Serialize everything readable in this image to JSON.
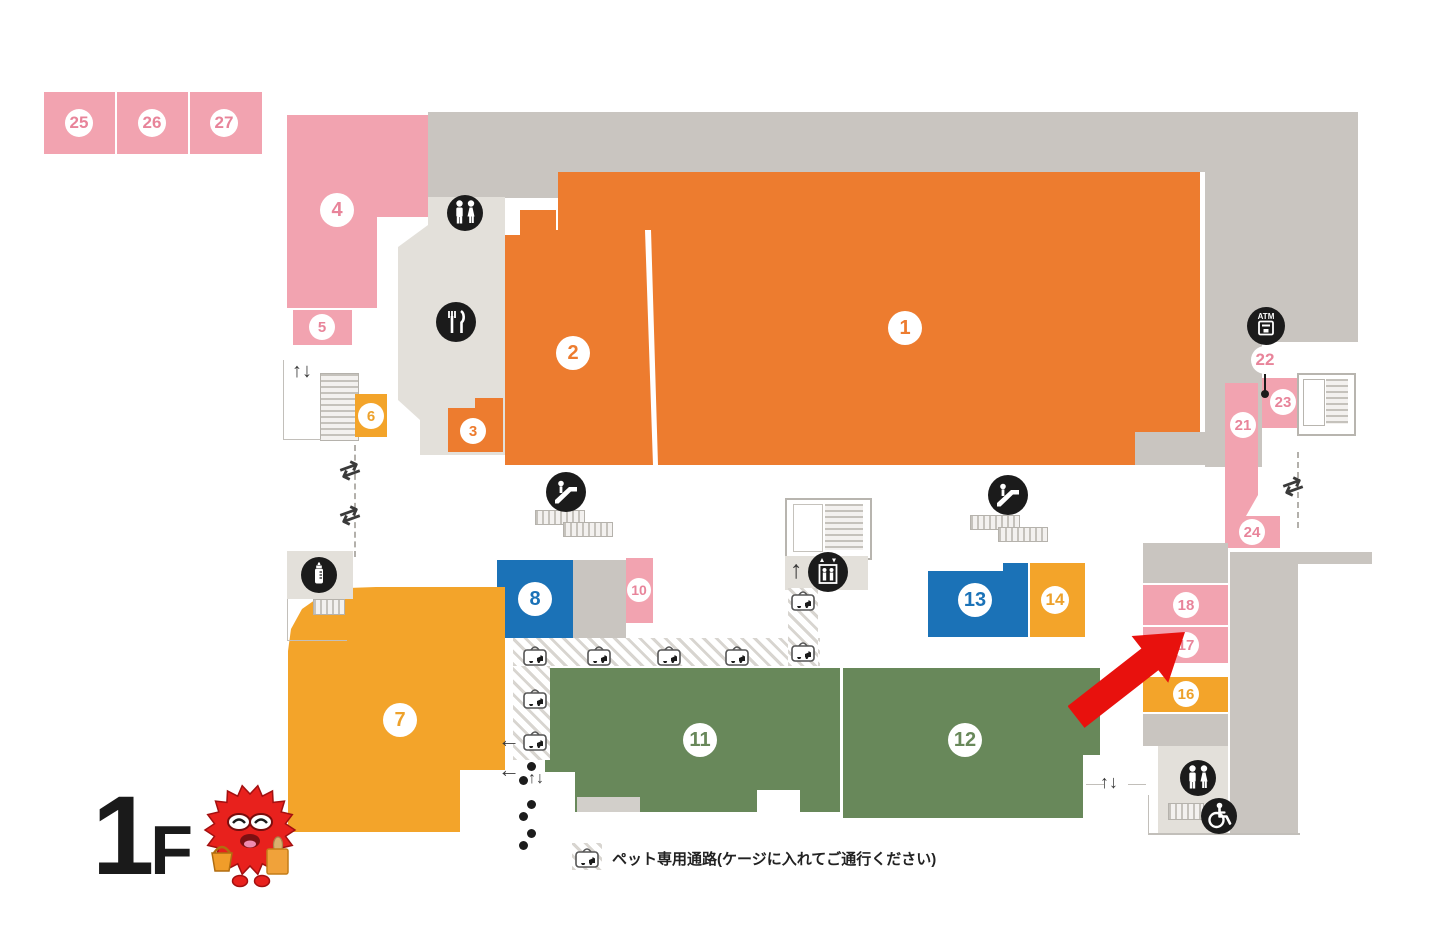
{
  "floor": {
    "label_number": "1",
    "label_letter": "F"
  },
  "legend": {
    "pet_path_text": "ペット専用通路(ケージに入れてご通行ください)"
  },
  "icons": {
    "atm_label": "ATM"
  },
  "arrows": {
    "up_down": "↑↓",
    "two_way": "⇄",
    "left": "←",
    "up": "↑"
  },
  "palette": {
    "pink": "#f2a3b0",
    "orange": "#ed7c2f",
    "amber": "#f3a42a",
    "blue": "#1b72b7",
    "green": "#68885a",
    "gray": "#c9c5c0",
    "light_gray": "#e3e0da",
    "red_arrow": "#e8110d",
    "icon_black": "#1b1b1b"
  },
  "areas": {
    "a1": {
      "label": "1",
      "color": "#ed7c2f"
    },
    "a2": {
      "label": "2",
      "color": "#ed7c2f"
    },
    "a3": {
      "label": "3",
      "color": "#ed7c2f"
    },
    "a4": {
      "label": "4",
      "color": "#f2a3b0"
    },
    "a5": {
      "label": "5",
      "color": "#f2a3b0"
    },
    "a6": {
      "label": "6",
      "color": "#f3a42a"
    },
    "a7": {
      "label": "7",
      "color": "#f3a42a"
    },
    "a8": {
      "label": "8",
      "color": "#1b72b7"
    },
    "a10": {
      "label": "10",
      "color": "#f2a3b0"
    },
    "a11": {
      "label": "11",
      "color": "#68885a"
    },
    "a12": {
      "label": "12",
      "color": "#68885a"
    },
    "a13": {
      "label": "13",
      "color": "#1b72b7"
    },
    "a14": {
      "label": "14",
      "color": "#f3a42a"
    },
    "a16": {
      "label": "16",
      "color": "#f3a42a"
    },
    "a17": {
      "label": "17",
      "color": "#f2a3b0"
    },
    "a18": {
      "label": "18",
      "color": "#f2a3b0"
    },
    "a21": {
      "label": "21",
      "color": "#f2a3b0"
    },
    "a22": {
      "label": "22",
      "color": "#f2a3b0"
    },
    "a23": {
      "label": "23",
      "color": "#f2a3b0"
    },
    "a24": {
      "label": "24",
      "color": "#f2a3b0"
    },
    "a25": {
      "label": "25",
      "color": "#f2a3b0"
    },
    "a26": {
      "label": "26",
      "color": "#f2a3b0"
    },
    "a27": {
      "label": "27",
      "color": "#f2a3b0"
    }
  }
}
